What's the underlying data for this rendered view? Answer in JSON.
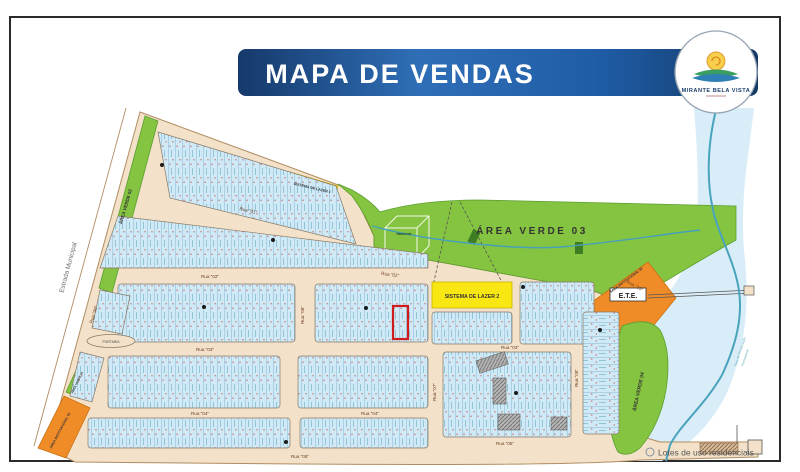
{
  "header": {
    "title": "MAPA  DE  VENDAS"
  },
  "logo": {
    "name": "MIRANTE BELA VISTA"
  },
  "legend": {
    "residential": "Lotes de uso residenciais"
  },
  "map": {
    "areas": {
      "verde01": "ÁREA VERDE 01",
      "verde02": "ÁREA VERDE 02",
      "verde03": "ÁREA  VERDE  03",
      "verde04": "ÁREA VERDE 04",
      "inst01": "ÁREA INSTITUCIONAL 01",
      "inst02": "ÁREA INSTITUCIONAL 02",
      "ete": "E.T.E.",
      "lazer1": "SISTEMA DE LAZER 1",
      "lazer2": "SISTEMA DE  LAZER  2",
      "nascente": "Nascente",
      "portaria": "PORTARIA"
    },
    "roads": {
      "estrada": "Estrada Municipal",
      "streets": [
        "Rua \"01\"",
        "Rua \"02\"",
        "Rua \"03\"",
        "Rua \"04\"",
        "Rua \"05\"",
        "Rua \"06\"",
        "Rua \"07\"",
        "Rua \"08\"",
        "Rua \"09\"",
        "Rua \"10\""
      ]
    },
    "water": {
      "app1": "Área de Preservação",
      "app2": "Permanente"
    }
  },
  "colors": {
    "header_blue": "#1f5ca6",
    "lot_blue": "#cfe9f6",
    "green": "#85c440",
    "yellow": "#f8e713",
    "orange": "#f08c28",
    "street_beige": "#f3e2c9",
    "highlight_red": "#cf1d1d",
    "river": "#4aa3bd"
  }
}
